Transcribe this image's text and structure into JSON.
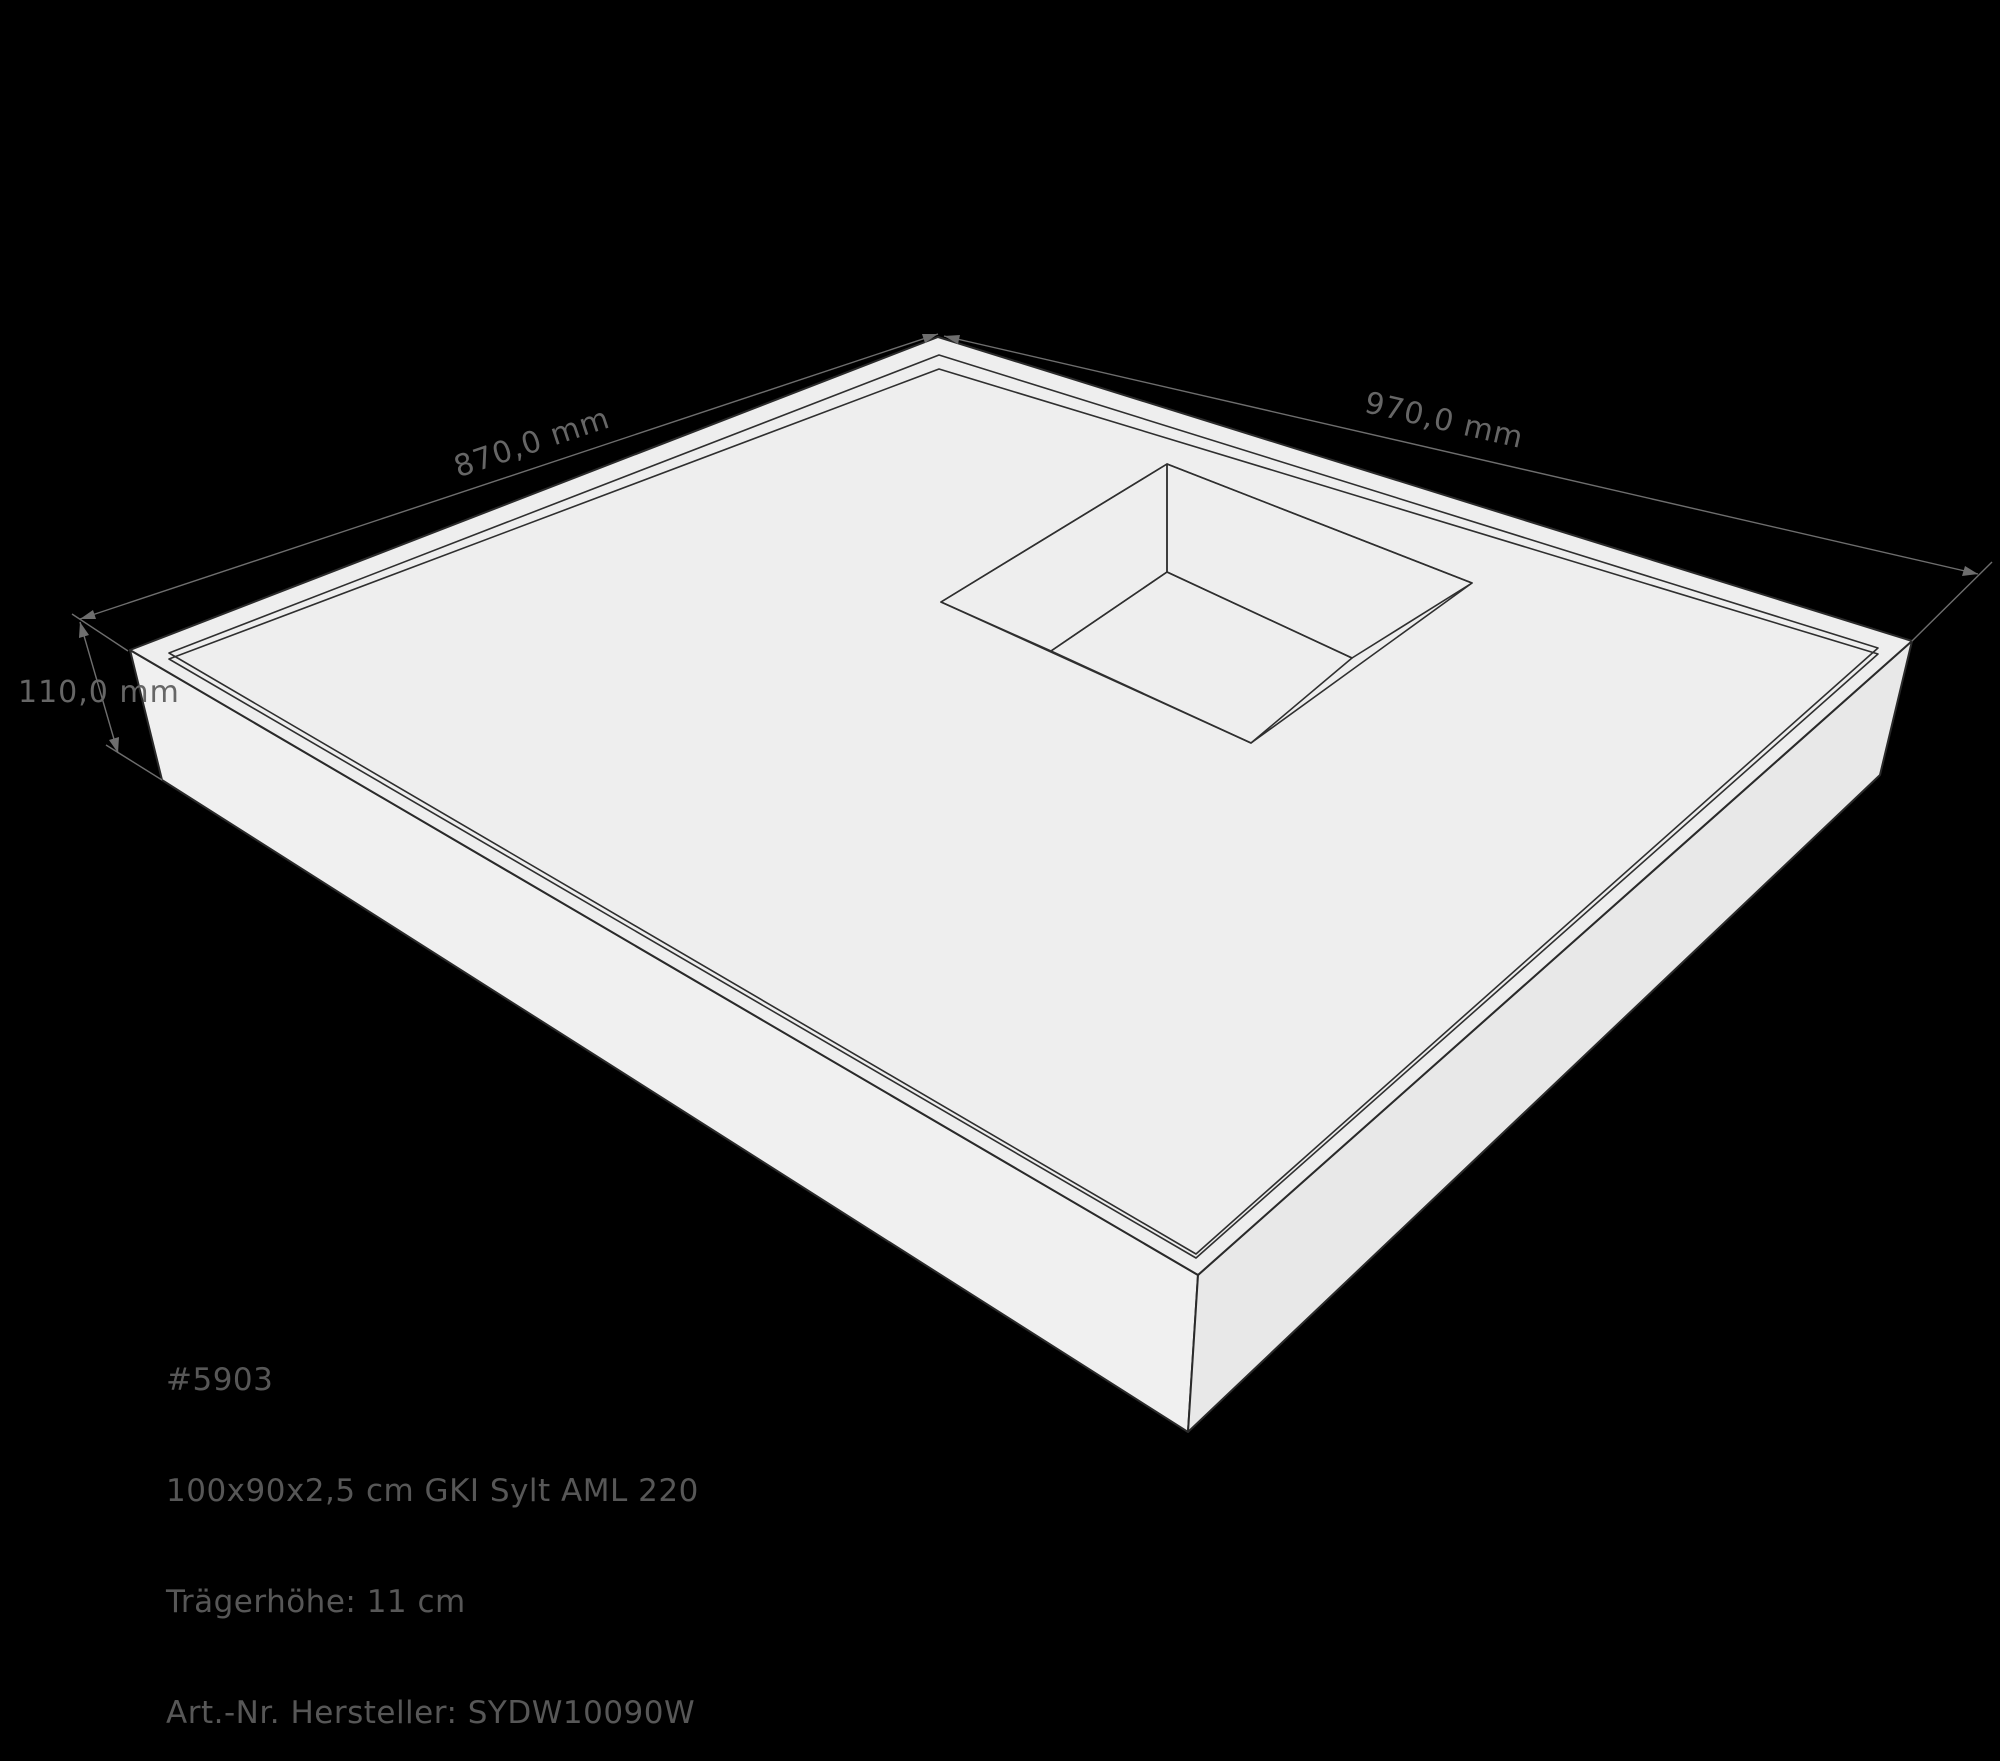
{
  "dimensions": {
    "width_label": "970,0 mm",
    "depth_label": "870,0 mm",
    "height_label": "110,0 mm"
  },
  "product_info": {
    "lines": [
      "#5903",
      "100x90x2,5 cm GKI Sylt AML 220",
      "Trägerhöhe: 11 cm",
      "Art.-Nr. Hersteller: SYDW10090W"
    ]
  },
  "colors": {
    "background": "#000000",
    "rim_surface": "#eeeeee",
    "recessed_surface": "#e4e4e4",
    "side_face_left": "#f0f0f0",
    "side_face_right": "#e8e8e8",
    "cutout_opening": "#e0e0e0",
    "cutout_wall_bright": "#f4f4f4",
    "cutout_wall_shaded": "#dfdfdf",
    "cutout_floor": "#000000",
    "outline": "#2a2a2a",
    "dimension_gray": "#6e6e6e",
    "info_text_gray": "#575757"
  }
}
